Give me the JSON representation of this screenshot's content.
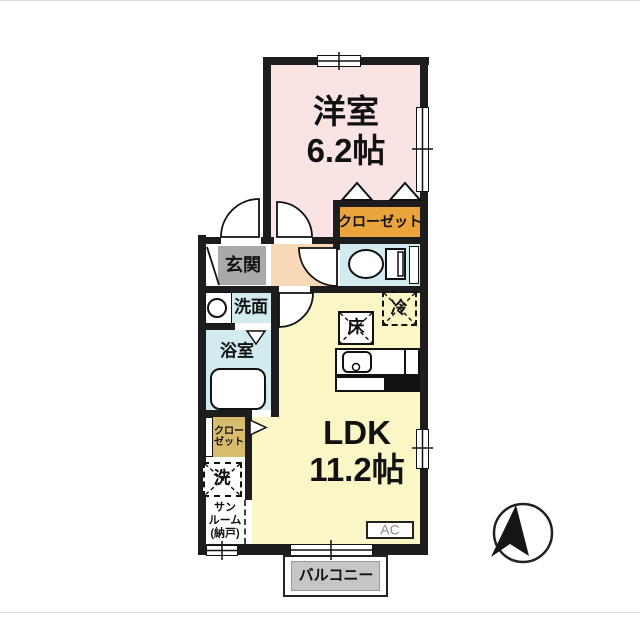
{
  "rooms": {
    "western_room": {
      "name": "洋室",
      "size": "6.2帖"
    },
    "ldk": {
      "name": "LDK",
      "size": "11.2帖"
    },
    "closet": {
      "name": "クローゼット"
    },
    "entrance": {
      "name": "玄関"
    },
    "washroom": {
      "name": "洗面"
    },
    "bathroom": {
      "name": "浴室"
    },
    "side_closet": {
      "line1": "クロー",
      "line2": "ゼット"
    },
    "sunroom": {
      "line1": "サン",
      "line2": "ルーム",
      "line3": "(納戸)"
    },
    "balcony": {
      "name": "バルコニー"
    }
  },
  "fixtures": {
    "floor_storage": "床",
    "refrigerator": "冷",
    "washer": "洗",
    "air_conditioner": "AC"
  },
  "colors": {
    "wall": "#1d1d1d",
    "western_room": "#fae3e3",
    "hallway": "#f7d8b7",
    "entrance": "#a9a9a9",
    "wet_area": "#d2ebee",
    "ldk": "#faf6c6",
    "closet": "#e9a43c",
    "side_closet": "#d8bc6e",
    "balcony": "#c6c6c6"
  }
}
